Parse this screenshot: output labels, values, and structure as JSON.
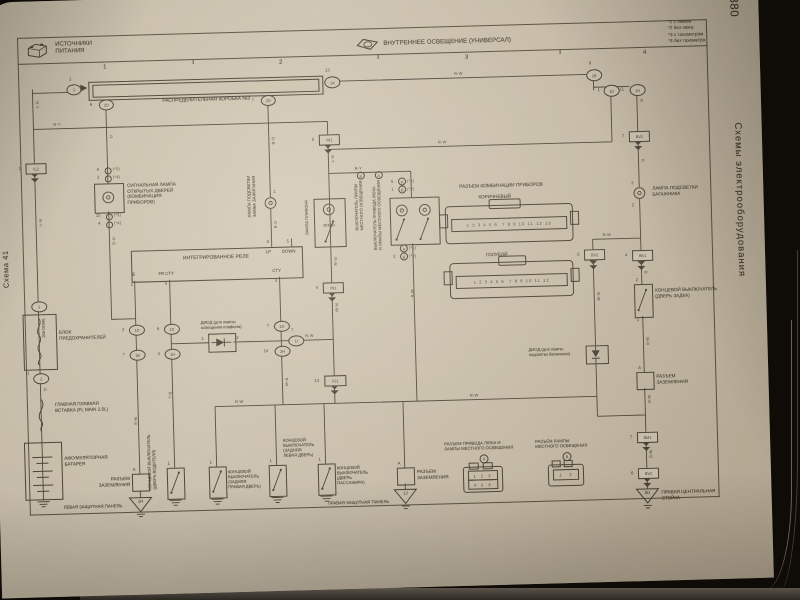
{
  "page": {
    "number": "380",
    "side_title": "Схемы электрооборудования",
    "scheme": "Схема 41"
  },
  "header": {
    "left_title": "ИСТОЧНИКИ\nПИТАНИЯ",
    "center_title": "ВНУТРЕННЕЕ ОСВЕЩЕНИЕ (УНИВЕРСАЛ)",
    "notes": "*1 с люком\n*2 без люка\n*3 с тахометром\n*4 без тахометра",
    "col1": "1",
    "col2": "2",
    "col3": "3",
    "col4": "4"
  },
  "labels": {
    "dist_box": "РАСПРЕДЕЛИТЕЛЬНАЯ КОРОБКА №3",
    "signal_lamp": "СИГНАЛЬНАЯ ЛАМПА\nОТКРЫТЫХ ДВЕРЕЙ\n(КОМБИНАЦИЯ\nПРИБОРОВ)",
    "ign_lamp": "ЛАМПА ПОДСВЕТКИ\nЗАМКА ЗАЖИГАНИЯ",
    "relay": "ИНТЕГРИРОВАННОЕ РЕЛЕ",
    "dome_lamp": "ЛАМПА ПЛАФОНА",
    "door": "DOOR",
    "sw_a": "ВЫКЛЮЧАТЕЛЬ ПРИВОДА ЛЮКА\nИ ЛАМПЫ МЕСТНОГО ОСВЕЩЕНИЯ",
    "sw_b": "ВЫКЛЮЧАТЕЛЬ ЛАМПЫ\nМЕСТНОГО ОСВЕЩЕНИЯ",
    "cluster_conn": "РАЗЪЕМ КОМБИНАЦИИ ПРИБОРОВ",
    "brown": "КОРИЧНЕВЫЙ",
    "blue": "ГОЛУБОЙ",
    "trunk_lamp": "ЛАМПА ПОДСВЕТКИ\nБАГАЖНИКА",
    "tailgate_sw": "КОНЦЕВОЙ ВЫКЛЮЧАТЕЛЬ\n(ДВЕРЬ ЗАДКА)",
    "ground_conn": "РАЗЪЕМ\nЗАЗЕМЛЕНИЯ",
    "trunk_diode": "ДИОД (для лампы\nподсветки багажника)",
    "dome_diode": "ДИОД (для лампы\nосвещения плафона)",
    "fuse_block": "БЛОК\nПРЕДОХРАНИТЕЛЕЙ",
    "fuse": "20A DOME",
    "main_fl": "ГЛАВНАЯ ПЛАВКАЯ\nВСТАВКА (FL MAIN 2.0L)",
    "battery": "АККУМУЛЯТОРНАЯ\nБАТАРЕЯ",
    "driver_sw": "КОНЦЕВОЙ ВЫКЛЮЧАТЕЛЬ\n(ДВЕРЬ ВОДИТЕЛЯ)",
    "rr_sw": "КОНЦЕВОЙ\nВЫКЛЮЧАТЕЛЬ\n(ЗАДНЯЯ\nПРАВАЯ ДВЕРЬ)",
    "rl_sw": "КОНЦЕВОЙ\nВЫКЛЮЧАТЕЛЬ\n(ЗАДНЯЯ\nЛЕВАЯ ДВЕРЬ)",
    "pass_sw": "КОНЦЕВОЙ\nВЫКЛЮЧАТЕЛЬ\n(ДВЕРЬ\nПАССАЖИРА)",
    "sunroof_conn": "РАЗЪЕМ ПРИВОДА ЛЮКА И\nЛАМПЫ МЕСТНОГО ОСВЕЩЕНИЯ",
    "map_conn": "РАЗЪЕМ ЛАМПЫ\nМЕСТНОГО ОСВЕЩЕНИЯ",
    "left_panel": "ЛЕВАЯ ЗАЩИТНАЯ ПАНЕЛЬ",
    "right_panel": "ПРАВАЯ ЗАЩИТНАЯ ПАНЕЛЬ",
    "center_pillar": "ПРАВАЯ ЦЕНТРАЛЬНАЯ\nСТОЙКА"
  },
  "wires": {
    "ry": "R-Y",
    "rw": "R-W",
    "rg": "R-G",
    "gb": "G-B",
    "wb": "W-B",
    "rl": "R-L",
    "r": "R",
    "b": "B"
  },
  "conn": {
    "il2": {
      "n": "1",
      "c": "IL2"
    },
    "in1a": {
      "n": "5",
      "c": "IN1"
    },
    "in1b": {
      "n": "4",
      "c": "IN1"
    },
    "io1": {
      "n": "13",
      "c": "IO1"
    },
    "bv2a": {
      "n": "5",
      "c": "BV2"
    },
    "bv2b": {
      "n": "7",
      "c": "BV2"
    },
    "bv2c": {
      "n": "6",
      "c": "BV2"
    },
    "bk1": {
      "n": "4",
      "c": "BK1"
    },
    "bm1": {
      "n": "7",
      "c": "BM1"
    },
    "o3": {
      "n": "2",
      "c": "3"
    },
    "o1a": {
      "n": "13",
      "c": "1A"
    },
    "o2d1": {
      "n": "6",
      "c": "2D"
    },
    "o2d2": {
      "n": "7",
      "c": "2D"
    },
    "e1": {
      "n": "2",
      "c": "1D"
    },
    "e2": {
      "n": "7",
      "c": "1B"
    },
    "f1": {
      "n": "6",
      "c": "1D"
    },
    "f2": {
      "n": "4",
      "c": "1H"
    },
    "c1": {
      "n": "7",
      "c": "1D"
    },
    "c2": {
      "n": "14",
      "c": "2H"
    },
    "c3": {
      "n": "7",
      "c": "1I"
    },
    "t1": {
      "n": "9",
      "c": "1B"
    },
    "t2": {
      "n": "1",
      "c": "1D"
    },
    "t3": {
      "n": "11",
      "c": "1H"
    },
    "fz1": {
      "c": "2"
    },
    "fz2": {
      "n": "1",
      "c": "2"
    }
  },
  "relay": {
    "e": "E",
    "fr": "FR CTY",
    "cty": "CTY",
    "lp": "LP",
    "down": "DOWN",
    "p1": "1",
    "p3": "3",
    "p4": "4",
    "p5": "5",
    "p8": "8"
  },
  "pins": {
    "sig1n": "9",
    "sig1note": "(*3)",
    "sig2n": "3",
    "sig2note": "(*4)",
    "sig3n": "15",
    "sig3note": "(*3)",
    "sig4n": "4",
    "sig4note": "(*4)",
    "asm1n": "6",
    "asm2n": "1",
    "asm4n": "2",
    "note1": "(*1)",
    "note2": "(*2)",
    "a": "A",
    "b": "B",
    "trunk_top": "3",
    "trunk_bot": "2",
    "tg_top": "2",
    "tg_bot": "1",
    "door": "1",
    "ign": "1",
    "d1": "1",
    "d2": "2"
  },
  "grounds": {
    "g1": "1H",
    "g2": "1J",
    "g3": "BJ",
    "a": "A"
  },
  "cluster": {
    "pins_a": "1 2 3 4 5 6  7 8 9 10 11 12 13",
    "pins_b": "1 2 3 4 5 6  7 8 9 10 11 12"
  },
  "smallconn": {
    "a1": "1 2 3",
    "a2": "4 5 6",
    "b1": "1   2"
  }
}
